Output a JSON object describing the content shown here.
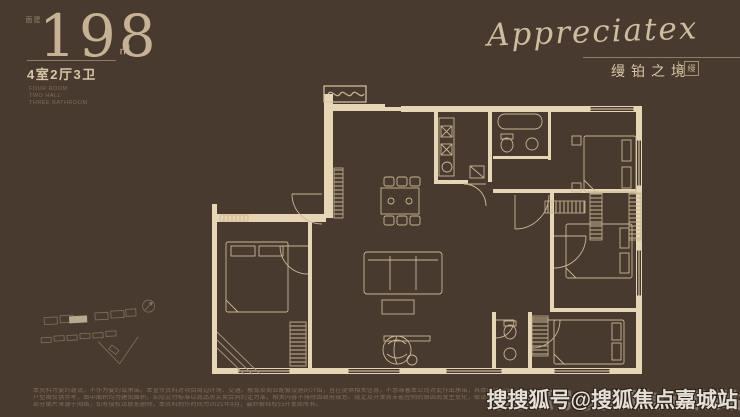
{
  "colors": {
    "background": "#493a2f",
    "wall_cream": "#e7d6b3",
    "furniture_line": "#c9b692",
    "headline_tan": "#c7b294",
    "watermark_gray": "#e3e0d9"
  },
  "header_left": {
    "area_label": "建面",
    "area_value": "198",
    "area_unit": "㎡",
    "layout_text": "4室2厅3卫",
    "sub_lines": [
      "FOUR ROOM",
      "TWO HALL",
      "THREE BATHROOM"
    ]
  },
  "header_right": {
    "brand_script": "Appreciatex",
    "brand_cn": "缦铂之境",
    "brand_seal": "缦"
  },
  "footer": {
    "disclaimer_lines": [
      "本资料为要约邀请，不作为要约或承诺。本宣传资料对项目周边环境、交通、教育及商业配套设施的介绍，旨在提供相关信息，不意味着本公司对此作出承诺，具体以政府部门最终审批文件为准。",
      "户型图仅供参考，图中面积均为建筑面积，实际交付标准以商品房买卖合同约定为准。相关内容不排除因政府规划、规定及开发商未能控制的原因而发生变化，敬请留意最新资料。",
      "部分图片来源于网络，如有侵权请联系删除。本资料制作时间为2021年9月，最终解释权归开发商所有。"
    ],
    "watermark": "搜搜狐号@搜狐焦点嘉城站"
  }
}
